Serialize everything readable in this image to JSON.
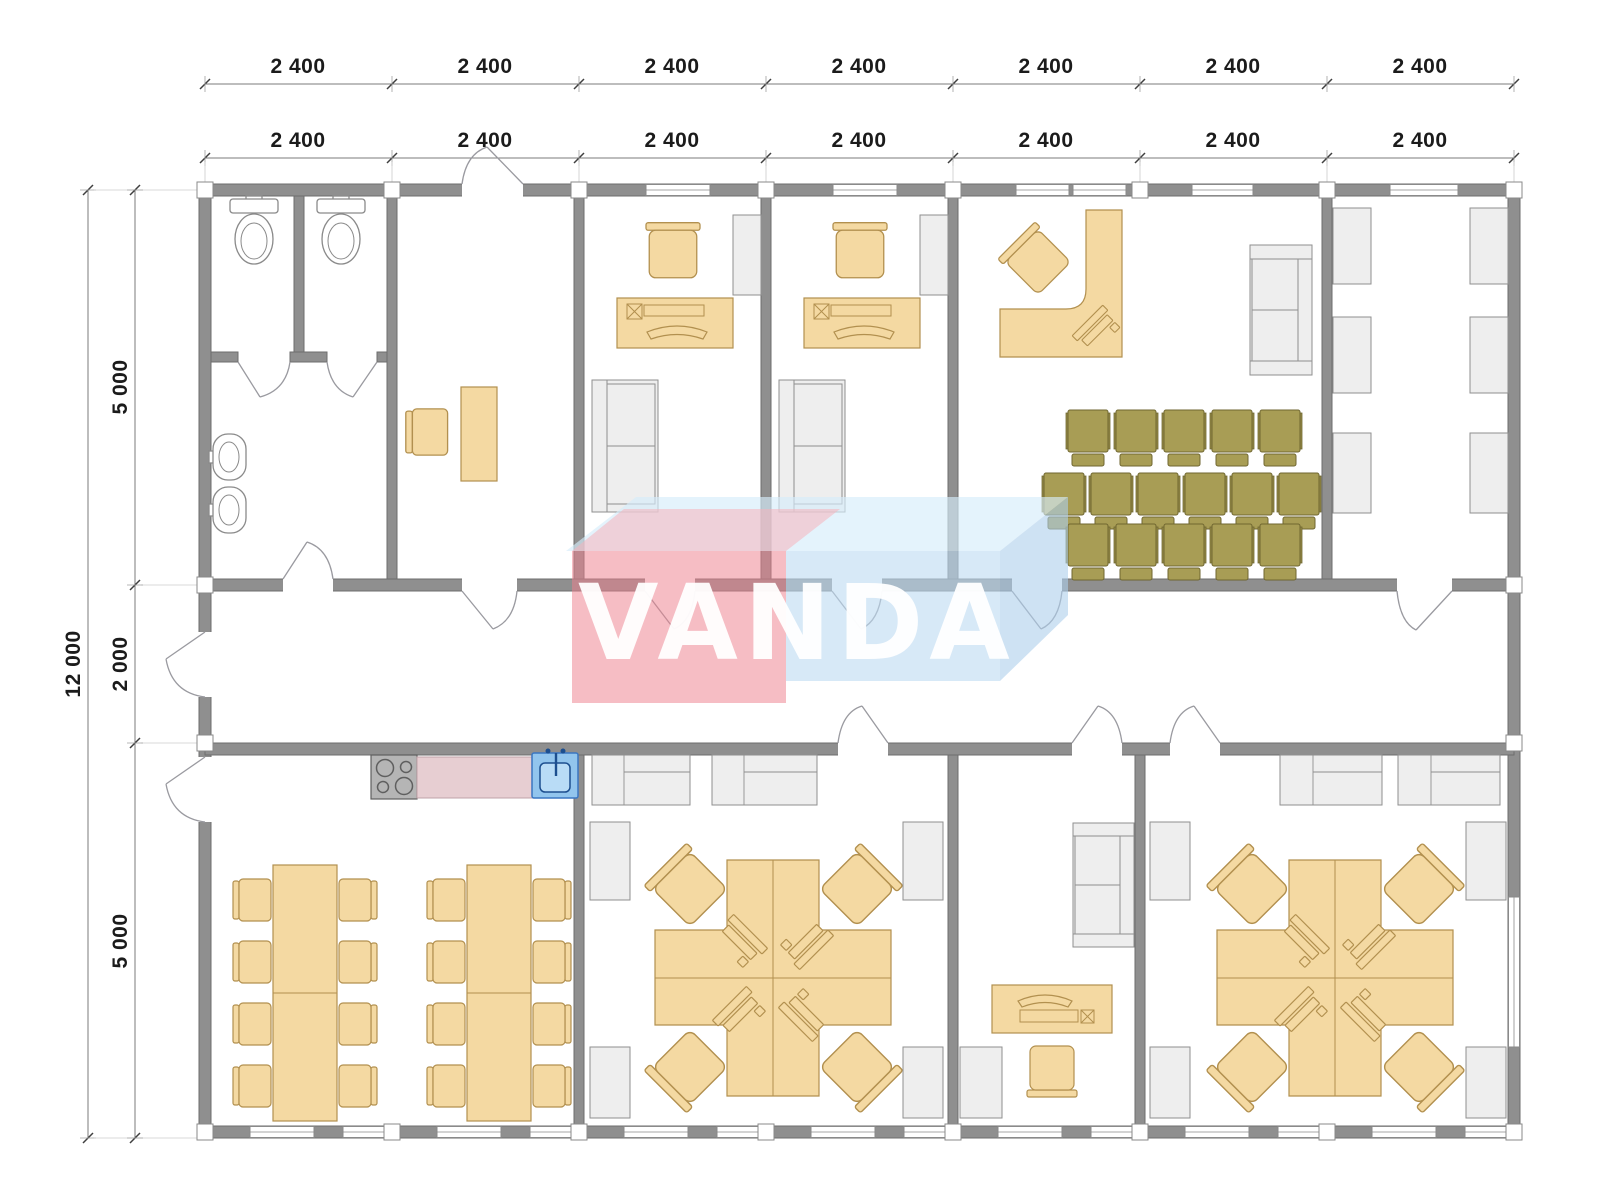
{
  "watermark": {
    "text": "VANDA"
  },
  "dimensions": {
    "top_row_outer": [
      "2 400",
      "2 400",
      "2 400",
      "2 400",
      "2 400",
      "2 400",
      "2 400"
    ],
    "top_row_inner": [
      "2 400",
      "2 400",
      "2 400",
      "2 400",
      "2 400",
      "2 400",
      "2 400"
    ],
    "left_total": "12 000",
    "left_segments": [
      "5 000",
      "2 000",
      "5 000"
    ]
  },
  "plan": {
    "modules_wide": 7,
    "module_width_mm": 2400,
    "depth_zones_mm": [
      5000,
      2000,
      5000
    ],
    "rooms": [
      {
        "id": "wc",
        "furniture": [
          "toilet",
          "toilet",
          "sink",
          "sink"
        ]
      },
      {
        "id": "entry-office",
        "furniture": [
          "desk",
          "chair"
        ]
      },
      {
        "id": "office-1",
        "furniture": [
          "desk",
          "computer",
          "chair",
          "cabinet",
          "sofa"
        ]
      },
      {
        "id": "office-2",
        "furniture": [
          "desk",
          "computer",
          "chair",
          "cabinet",
          "sofa"
        ]
      },
      {
        "id": "conference-room",
        "furniture": [
          "l-desk",
          "computer",
          "chair",
          "sofa",
          "chair-row-5",
          "chair-row-6",
          "chair-row-5"
        ]
      },
      {
        "id": "storage",
        "furniture": [
          "cabinet",
          "cabinet",
          "cabinet",
          "cabinet",
          "cabinet",
          "cabinet"
        ]
      },
      {
        "id": "canteen-kitchen",
        "furniture": [
          "stove",
          "counter",
          "kitchen-sink",
          "dining-table-8",
          "dining-table-8"
        ]
      },
      {
        "id": "open-office-1",
        "furniture": [
          "workstation-cluster-4",
          "cabinets",
          "cabinet",
          "cabinet",
          "cabinet",
          "cabinet"
        ]
      },
      {
        "id": "manager-office",
        "furniture": [
          "sofa",
          "desk",
          "computer",
          "chair",
          "cabinet"
        ]
      },
      {
        "id": "open-office-2",
        "furniture": [
          "workstation-cluster-4",
          "cabinets",
          "cabinet",
          "cabinet",
          "cabinet",
          "cabinet"
        ]
      }
    ]
  },
  "colors": {
    "wall": "#8f8f8f",
    "wall-edge": "#6e6e6e",
    "line": "#8a8a8a",
    "furniture": "#f4d9a2",
    "furniture-edge": "#b2904f",
    "chair-olive": "#a89d55",
    "chair-olive-arm": "#958a48",
    "chair-olive-edge": "#6f6630",
    "cabinet": "#eeeeee",
    "cabinet-edge": "#8f8f8f",
    "counter-pink": "#e7ced2",
    "counter-pink-edge": "#bfa3a8",
    "sink-blue": "#92c5ed",
    "sink-blue-light": "#b9dcf6",
    "sink-blue-dark": "#1d4f8f",
    "stove": "#b5b5b5",
    "dim-text": "#1b1b1b",
    "wm-red": "rgba(238,128,141,0.52)",
    "wm-red-top": "rgba(245,178,188,0.55)",
    "wm-blue": "rgba(189,219,242,0.60)",
    "wm-blue-top": "rgba(214,236,250,0.65)",
    "wm-blue-side": "rgba(173,207,235,0.60)",
    "wm-text": "rgba(255,255,255,0.95)"
  }
}
